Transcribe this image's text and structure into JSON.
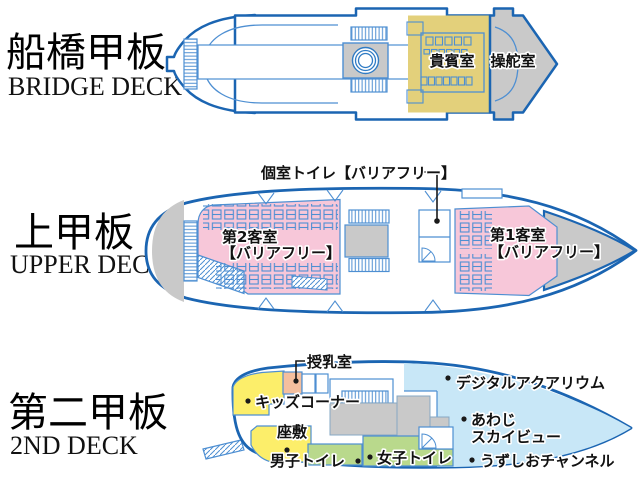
{
  "page": {
    "background": "#ffffff"
  },
  "colors": {
    "hull_outline": "#1b65b2",
    "detail_blue": "#4e8fd2",
    "light_blue_fill": "#c8e7f7",
    "gray_fill": "#c9c9c9",
    "tan_fill": "#e3d07b",
    "pink_fill": "#f7c7d9",
    "yellow_fill": "#fcee6a",
    "green_fill": "#b9d98c",
    "salmon_fill": "#f4bf9e"
  },
  "decks": [
    {
      "title_jp": "船橋甲板",
      "title_en": "BRIDGE DECK",
      "rooms": {
        "vip": "貴賓室",
        "wheelhouse": "操舵室"
      }
    },
    {
      "title_jp": "上甲板",
      "title_en": "UPPER DECK",
      "rooms": {
        "toilet_label": "個室トイレ【バリアフリー】",
        "cabin2_name": "第2客室",
        "cabin2_note": "【バリアフリー】",
        "cabin1_name": "第1客室",
        "cabin1_note": "【バリアフリー】"
      }
    },
    {
      "title_jp": "第二甲板",
      "title_en": "2ND DECK",
      "rooms": {
        "nursing": "授乳室",
        "kids": "キッズコーナー",
        "tatami": "座敷",
        "mens_toilet": "男子トイレ",
        "womens_toilet": "女子トイレ",
        "digital_aquarium": "デジタルアクアリウム",
        "awaji_line1": "あわじ",
        "awaji_line2": "スカイビュー",
        "uzushio": "うずしおチャンネル"
      }
    }
  ]
}
